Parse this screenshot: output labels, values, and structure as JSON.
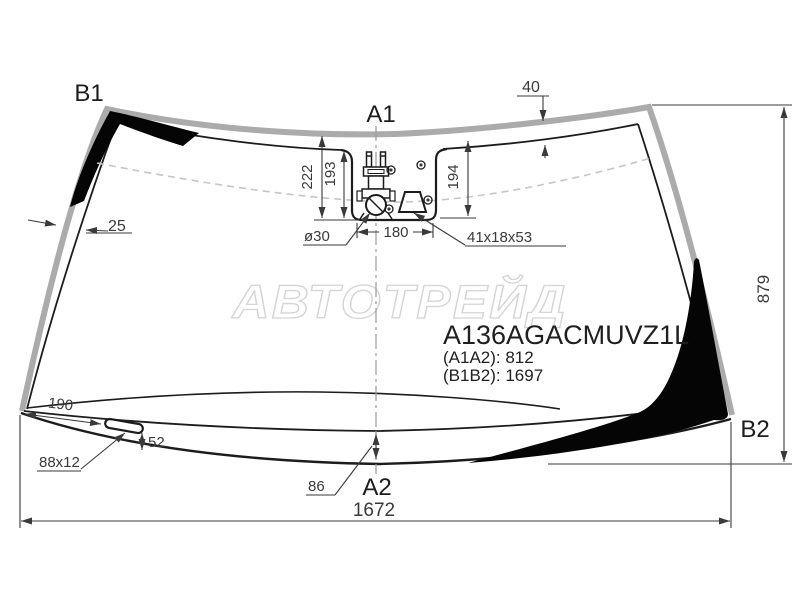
{
  "diagram": {
    "watermark": "АВТОТРЕЙД",
    "part": {
      "code": "A136AGACMUVZ1L",
      "a1a2": "(A1A2): 812",
      "b1b2": "(B1B2): 1697"
    },
    "corner_labels": {
      "b1": "B1",
      "a1": "A1",
      "a2": "A2",
      "b2": "B2"
    },
    "dimensions": {
      "edge_left": "25",
      "edge_top": "40",
      "sensor_depth_outer": "222",
      "sensor_depth_inner": "193",
      "sensor_depth_right": "194",
      "sensor_width": "180",
      "sensor_hole": "ø30",
      "mirror_pad": "41x18x53",
      "height_right": "879",
      "slot_offset": "190",
      "slot_size": "88x12",
      "slot_height": "52",
      "edge_bottom": "86",
      "width_bottom": "1672"
    },
    "colors": {
      "line": "#1c1c1c",
      "moulding": "#ababab",
      "band": "#050505",
      "dim": "#3a3a3a",
      "dashed": "#c6c6c6",
      "watermark": "#d4d4d4"
    }
  }
}
